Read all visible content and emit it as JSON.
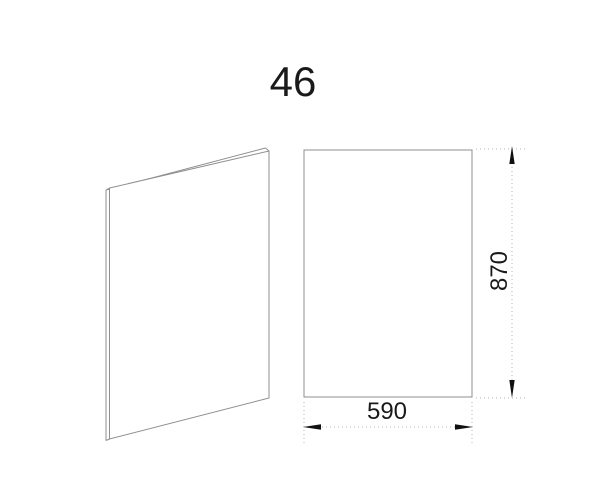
{
  "title": "46",
  "front_view": {
    "width_label": "590",
    "height_label": "870"
  },
  "colors": {
    "background": "#ffffff",
    "outline": "#8f8f8f",
    "dimension_line": "#b5b5b5",
    "text_and_arrows": "#111111"
  }
}
